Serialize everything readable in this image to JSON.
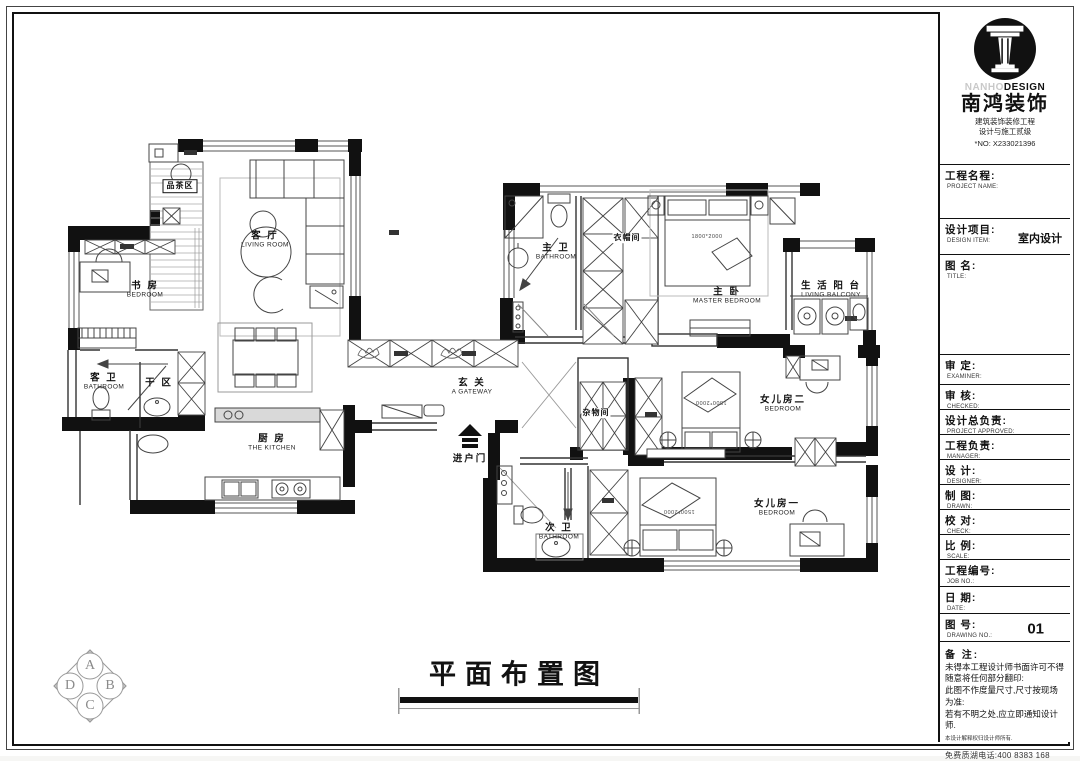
{
  "sheet": {
    "bottom_title": "平面布置图"
  },
  "logo": {
    "en_light": "NANHO",
    "en_bold": "DESIGN",
    "cn": "南鸿装饰",
    "sub1": "建筑装饰装修工程",
    "sub2": "设计与施工贰级",
    "no": "*NO: X233021396"
  },
  "title_block": {
    "fields": [
      {
        "cn": "工程名程:",
        "en": "PROJECT NAME:",
        "value": ""
      },
      {
        "cn": "设计项目:",
        "en": "DESIGN ITEM:",
        "value": "室内设计"
      },
      {
        "cn": "图  名:",
        "en": "TITLE:",
        "value": ""
      },
      {
        "cn": "审  定:",
        "en": "EXAMINER:",
        "value": ""
      },
      {
        "cn": "审  核:",
        "en": "CHECKED:",
        "value": ""
      },
      {
        "cn": "设计总负责:",
        "en": "PROJECT APPROVED:",
        "value": ""
      },
      {
        "cn": "工程负责:",
        "en": "MANAGER:",
        "value": ""
      },
      {
        "cn": "设  计:",
        "en": "DESIGNER:",
        "value": ""
      },
      {
        "cn": "制  图:",
        "en": "DRAWN:",
        "value": ""
      },
      {
        "cn": "校  对:",
        "en": "CHECK:",
        "value": ""
      },
      {
        "cn": "比  例:",
        "en": "SCALE:",
        "value": ""
      },
      {
        "cn": "工程编号:",
        "en": "JOB NO.:",
        "value": ""
      },
      {
        "cn": "日  期:",
        "en": "DATE:",
        "value": ""
      },
      {
        "cn": "图  号:",
        "en": "DRAWING NO.:",
        "value": "01"
      }
    ],
    "notes_title": "备 注:",
    "note1": "未得本工程设计师书面许可不得随意将任何部分翻印:",
    "note2": "此图不作度量尺寸,尺寸按现场为准:",
    "note3": "若有不明之处,应立即通知设计师.",
    "notes_small": "本设计解释权归设计师所有.",
    "hotline": "免费质湖电话:400 8383 168"
  },
  "rooms": {
    "tea": {
      "cn": "品茶区",
      "en": ""
    },
    "living": {
      "cn": "客 厅",
      "en": "LIVING ROOM"
    },
    "study": {
      "cn": "书 房",
      "en": "BEDROOM"
    },
    "guest_bath": {
      "cn": "客 卫",
      "en": "BATHROOM"
    },
    "dry_area": {
      "cn": "干 区",
      "en": ""
    },
    "kitchen": {
      "cn": "厨 房",
      "en": "THE KITCHEN"
    },
    "gateway": {
      "cn": "玄 关",
      "en": "A GATEWAY"
    },
    "entry_door": {
      "cn": "进户门",
      "en": ""
    },
    "master_bath": {
      "cn": "主 卫",
      "en": "BATHROOM"
    },
    "cloakroom": {
      "cn": "衣帽间",
      "en": ""
    },
    "master_bed": {
      "cn": "主 卧",
      "en": "MASTER BEDROOM",
      "bed_size": "1800*2000"
    },
    "balcony": {
      "cn": "生 活 阳 台",
      "en": "LIVING BALCONY"
    },
    "storage": {
      "cn": "杂物间",
      "en": ""
    },
    "daughter2": {
      "cn": "女儿房二",
      "en": "BEDROOM",
      "bed_size": "1500*2000"
    },
    "daughter1": {
      "cn": "女儿房一",
      "en": "BEDROOM",
      "bed_size": "1500*2000"
    },
    "second_bath": {
      "cn": "次 卫",
      "en": "BATHROOM"
    }
  },
  "stamp": {
    "l1": "A",
    "l2": "D",
    "l3": "C",
    "l4": "B"
  }
}
